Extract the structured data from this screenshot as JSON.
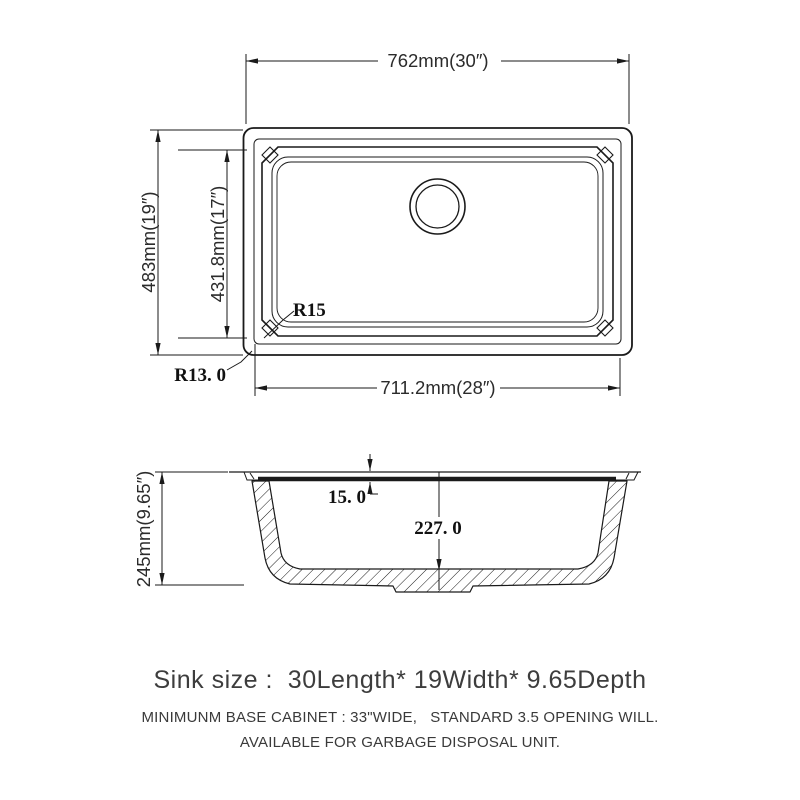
{
  "colors": {
    "line": "#1a1a1a",
    "dim_text": "#2b2b2b",
    "caption_text": "#3d3d3d"
  },
  "top_view": {
    "width_label": "762mm(30″)",
    "overall_height_label": "483mm(19″)",
    "bowl_height_label": "431.8mm(17″)",
    "bowl_width_label": "711.2mm(28″)",
    "bowl_corner_radius_label": "R15",
    "outer_corner_radius_label": "R13. 0"
  },
  "side_view": {
    "depth_label": "245mm(9.65″)",
    "rim_thickness_label": "15. 0",
    "bowl_depth_label": "227. 0"
  },
  "caption": {
    "size_line": "Sink size :  30Length* 19Width* 9.65Depth",
    "note_line1": "MINIMUNM BASE CABINET : 33\"WIDE,   STANDARD 3.5 OPENING WILL.",
    "note_line2": "AVAILABLE FOR GARBAGE DISPOSAL UNIT."
  }
}
